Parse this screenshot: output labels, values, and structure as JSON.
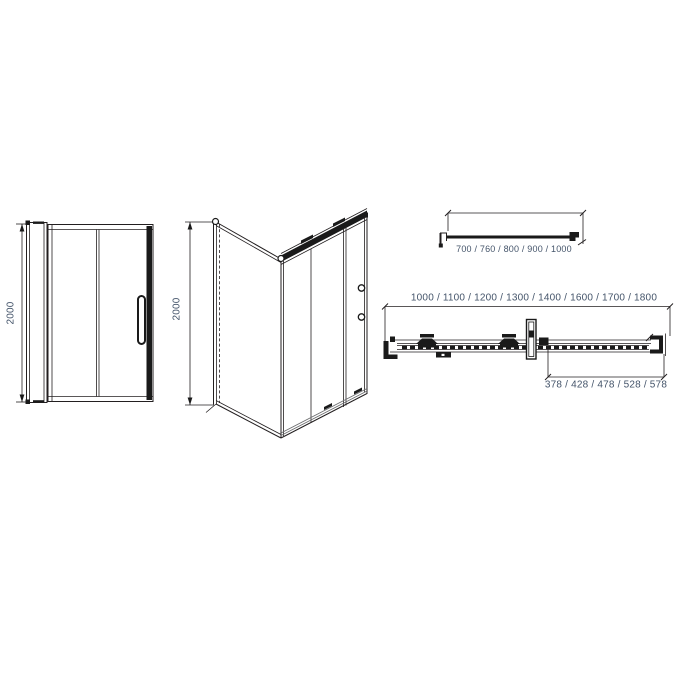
{
  "drawing": {
    "type": "sliding-shower-door-technical-drawing",
    "colors": {
      "background": "#ffffff",
      "line": "#231f20",
      "line_light": "#6b6c6e",
      "dimension_text": "#44546a"
    },
    "views": {
      "front": {
        "height_dimension": "2000"
      },
      "perspective": {
        "height_dimension": "2000"
      },
      "side_panel_plan": {
        "width_options": "700 / 760 / 800 / 900 / 1000"
      },
      "door_plan": {
        "width_options": "1000 / 1100 / 1200 / 1300 / 1400 / 1600 / 1700 / 1800",
        "sliding_section_widths": "378 / 428 / 478 / 528 / 578"
      }
    }
  }
}
